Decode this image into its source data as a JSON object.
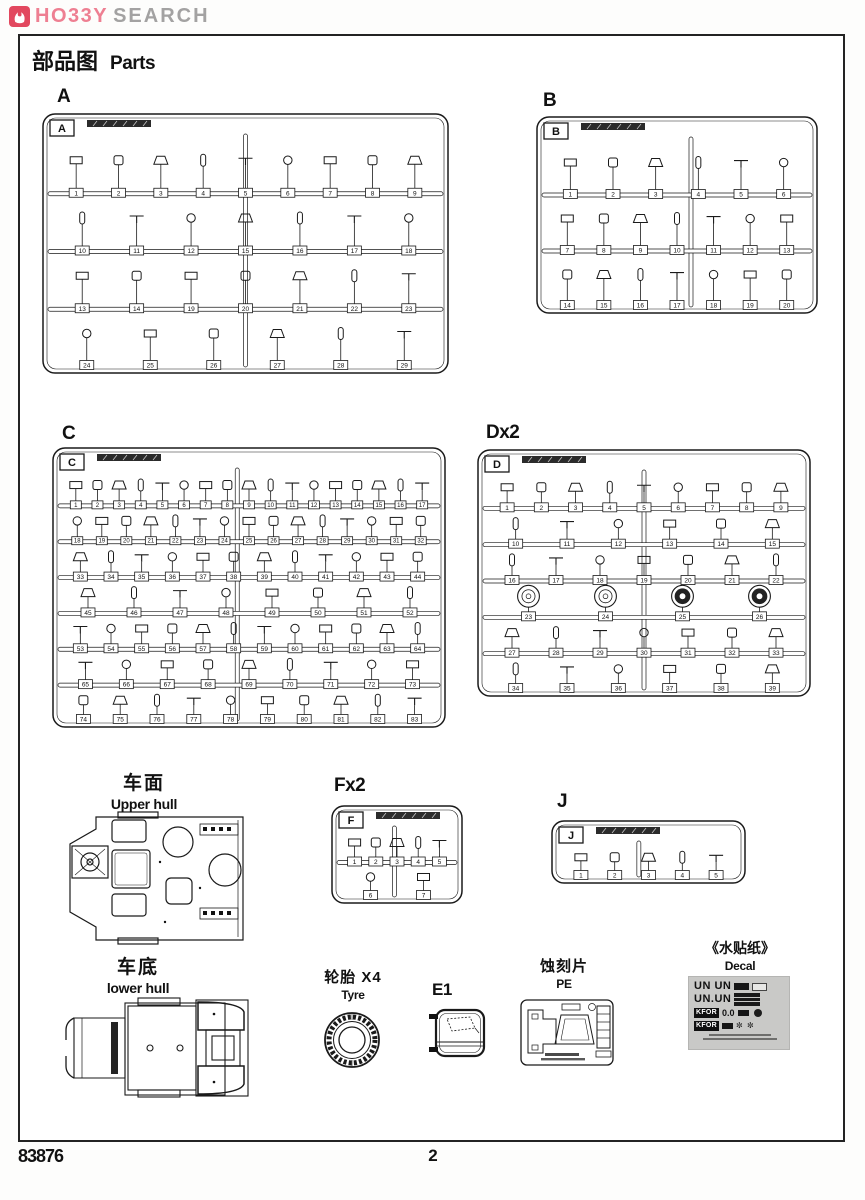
{
  "logo": {
    "brand_hobby": "HO33Y",
    "brand_search": "SEARCH",
    "icon_color": "#e2485f",
    "hobby_color": "#ee7f92",
    "search_color": "#a3a2a2"
  },
  "page": {
    "title_cjk": "部品图",
    "title_en": "Parts",
    "footer_code": "83876",
    "page_number": "2"
  },
  "sections": {
    "upper_hull": {
      "title_cjk": "车面",
      "title_en": "Upper hull"
    },
    "lower_hull": {
      "title_cjk": "车底",
      "title_en": "lower hull"
    },
    "tyre": {
      "title_cjk": "轮胎 X4",
      "title_en": "Tyre"
    },
    "e1": {
      "label": "E1"
    },
    "pe": {
      "title_cjk": "蚀刻片",
      "title_en": "PE"
    },
    "decal": {
      "title_cjk": "《水贴纸》",
      "title_en": "Decal",
      "row1": "UN UN",
      "row2": "UN.UN",
      "kfor": "KFOR",
      "zero": "0.0",
      "snow": "✼ ✼"
    }
  },
  "sprues": [
    {
      "id": "A",
      "heading": "A",
      "label": "A",
      "x": 43,
      "y": 114,
      "w": 405,
      "h": 259,
      "hx": 57,
      "hy": 86,
      "vdivs": [
        0.5
      ],
      "rows": [
        {
          "parts": [
            1,
            2,
            3,
            4,
            5,
            6,
            7,
            8,
            9
          ]
        },
        {
          "parts": [
            10,
            11,
            12,
            15,
            16,
            17,
            18
          ]
        },
        {
          "parts": [
            13,
            14,
            19,
            20,
            21,
            22,
            23
          ]
        },
        {
          "parts": [
            24,
            25,
            26,
            27,
            28,
            29
          ]
        }
      ]
    },
    {
      "id": "B",
      "heading": "B",
      "label": "B",
      "x": 537,
      "y": 117,
      "w": 280,
      "h": 196,
      "hx": 543,
      "hy": 90,
      "vdivs": [
        0.55
      ],
      "rows": [
        {
          "parts": [
            1,
            2,
            3,
            4,
            5,
            6
          ]
        },
        {
          "parts": [
            7,
            8,
            9,
            10,
            11,
            12,
            13
          ]
        },
        {
          "parts": [
            14,
            15,
            16,
            17,
            18,
            19,
            20
          ]
        }
      ]
    },
    {
      "id": "C",
      "heading": "C",
      "label": "C",
      "x": 53,
      "y": 448,
      "w": 392,
      "h": 279,
      "hx": 62,
      "hy": 423,
      "vdivs": [
        0.47
      ],
      "rows": [
        {
          "parts": [
            1,
            2,
            3,
            4,
            5,
            6,
            7,
            8,
            9,
            10,
            11,
            12,
            13,
            14,
            15,
            16,
            17
          ]
        },
        {
          "parts": [
            18,
            19,
            20,
            21,
            22,
            23,
            24,
            25,
            26,
            27,
            28,
            29,
            30,
            31,
            32
          ]
        },
        {
          "parts": [
            33,
            34,
            35,
            36,
            37,
            38,
            39,
            40,
            41,
            42,
            43,
            44
          ]
        },
        {
          "parts": [
            45,
            46,
            47,
            48,
            49,
            50,
            51,
            52
          ]
        },
        {
          "parts": [
            53,
            54,
            55,
            56,
            57,
            58,
            59,
            60,
            61,
            62,
            63,
            64
          ]
        },
        {
          "parts": [
            65,
            66,
            67,
            68,
            69,
            70,
            71,
            72,
            73
          ]
        },
        {
          "parts": [
            74,
            75,
            76,
            77,
            78,
            79,
            80,
            81,
            82,
            83
          ]
        }
      ]
    },
    {
      "id": "D",
      "heading": "Dx2",
      "label": "D",
      "x": 478,
      "y": 450,
      "w": 332,
      "h": 246,
      "hx": 486,
      "hy": 422,
      "vdivs": [
        0.5
      ],
      "rows": [
        {
          "parts": [
            1,
            2,
            3,
            4,
            5,
            6,
            7,
            8,
            9
          ]
        },
        {
          "parts": [
            10,
            11,
            12,
            13,
            14,
            15
          ]
        },
        {
          "parts": [
            16,
            17,
            18,
            19,
            20,
            21,
            22
          ]
        },
        {
          "parts": [
            23,
            24,
            25,
            26
          ],
          "glyph": "wheel"
        },
        {
          "parts": [
            27,
            28,
            29,
            30,
            31,
            32,
            33
          ]
        },
        {
          "parts": [
            34,
            35,
            36,
            37,
            38,
            39
          ]
        }
      ]
    },
    {
      "id": "F",
      "heading": "Fx2",
      "label": "F",
      "x": 332,
      "y": 806,
      "w": 130,
      "h": 97,
      "hx": 334,
      "hy": 775,
      "vdivs": [
        0.48
      ],
      "rows": [
        {
          "parts": [
            1,
            2,
            3,
            4,
            5
          ]
        },
        {
          "parts": [
            6,
            7
          ]
        }
      ]
    },
    {
      "id": "J",
      "heading": "J",
      "label": "J",
      "x": 552,
      "y": 821,
      "w": 193,
      "h": 62,
      "hx": 557,
      "hy": 791,
      "vdivs": [
        0.45
      ],
      "rows": [
        {
          "parts": [
            1,
            2,
            3,
            4,
            5
          ]
        }
      ]
    }
  ]
}
